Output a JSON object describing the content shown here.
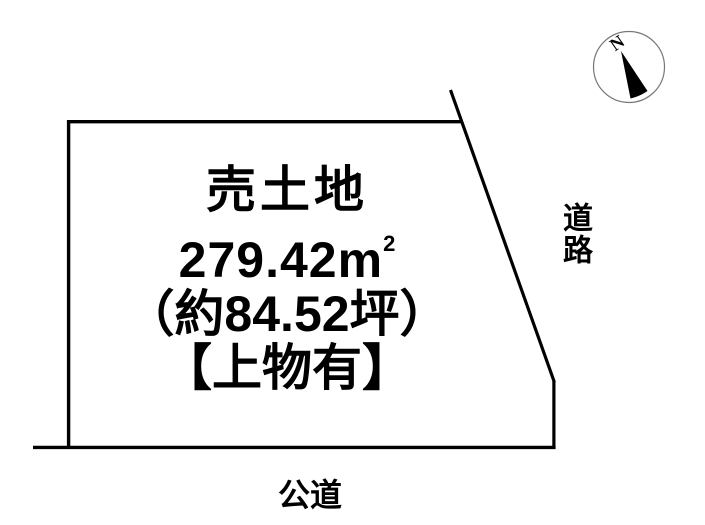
{
  "parcel": {
    "title": "売土地",
    "area_sqm": "279.42m",
    "area_sqm_sup": "2",
    "area_tsubo": "（約84.52坪）",
    "note": "【上物有】"
  },
  "roads": {
    "right_label": "道路",
    "bottom_label": "公道"
  },
  "compass": {
    "north_label": "N"
  },
  "colors": {
    "background": "#ffffff",
    "line": "#000000",
    "text": "#000000",
    "compass_outline": "#777777",
    "compass_needle": "#000000"
  }
}
